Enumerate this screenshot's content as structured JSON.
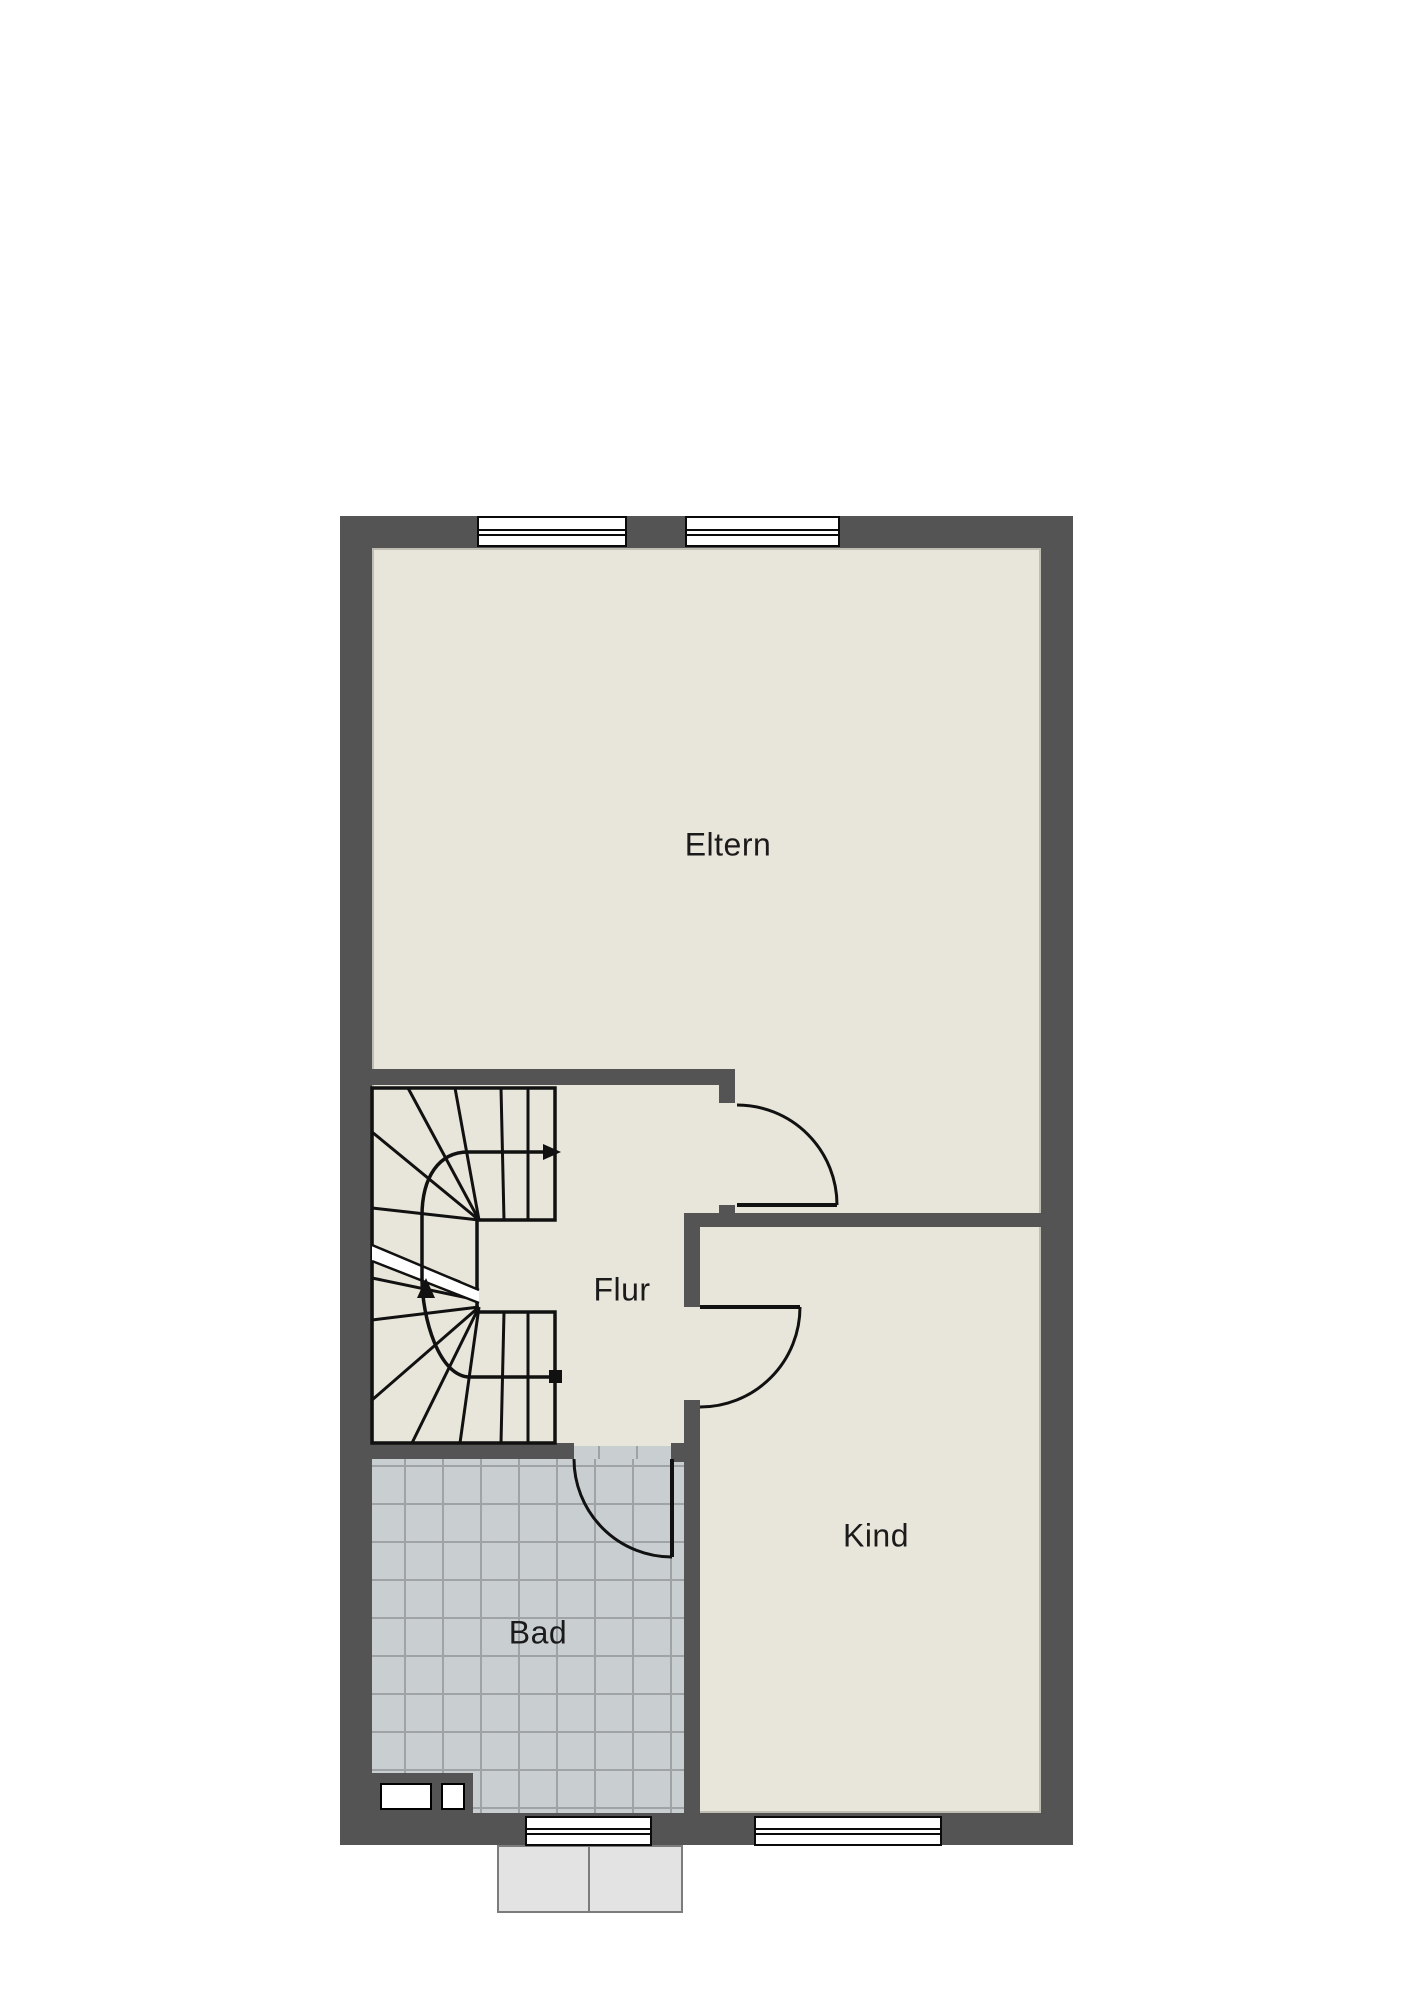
{
  "document": {
    "type": "floor-plan",
    "floor_hint": "upper floor with stair"
  },
  "colors": {
    "wall": "#545454",
    "floor": "#e8e5da",
    "line": "#111111",
    "tile": "#c9ced1",
    "tile_grout": "#9fa3a6",
    "window_fill": "#ffffff",
    "window_border": "#0a0a0a",
    "porch_fill": "#e3e3e3",
    "porch_border": "#7c7c7c",
    "label": "#1b1b1b",
    "page": "#ffffff"
  },
  "rooms": [
    {
      "id": "eltern",
      "label": "Eltern"
    },
    {
      "id": "flur",
      "label": "Flur"
    },
    {
      "id": "kind",
      "label": "Kind"
    },
    {
      "id": "bad",
      "label": "Bad"
    }
  ],
  "symbols": {
    "windows": [
      "top-left",
      "top-right",
      "bottom-left",
      "bottom-right"
    ],
    "doors": [
      "eltern-door",
      "kind-door",
      "bad-door"
    ],
    "stair": "u-shaped winder staircase with walk line, up arrow and break line"
  }
}
